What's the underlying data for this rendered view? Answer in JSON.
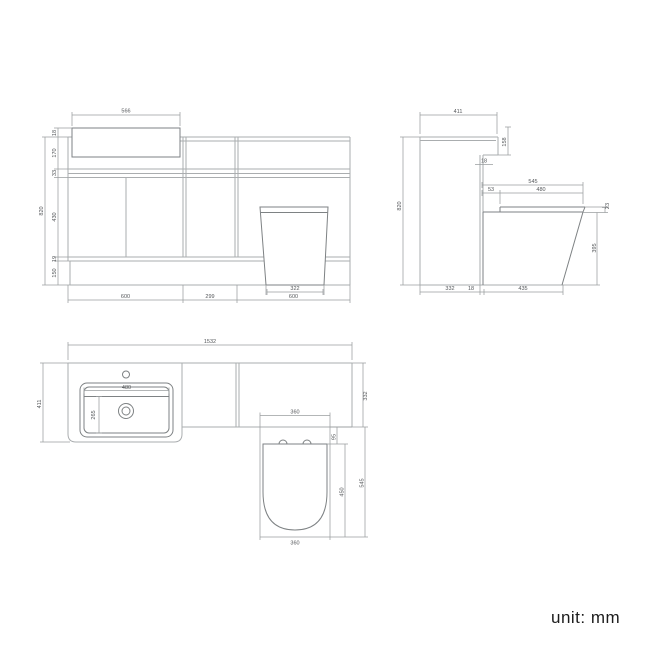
{
  "unit_note": "unit: mm",
  "front_view": {
    "dims": {
      "basin_width": "566",
      "basin_lip": "18",
      "counter_height": "170",
      "worktop_band": "33",
      "door_height": "430",
      "kick_gap": "19",
      "plinth_height": "150",
      "overall_height": "820",
      "left_unit_width": "600",
      "middle_unit_width": "299",
      "right_unit_width": "600",
      "toilet_base_width": "322"
    }
  },
  "side_view": {
    "dims": {
      "overall_depth": "411",
      "end_panel_drop": "158",
      "worktop_thickness": "18",
      "pan_projection_total": "545",
      "seat_setback": "53",
      "seat_length": "480",
      "seat_thickness": "23",
      "pan_height": "395",
      "overall_height": "820",
      "unit_depth": "332",
      "back_panel": "18",
      "pan_depth": "435"
    }
  },
  "plan_view": {
    "dims": {
      "overall_width": "1532",
      "vanity_depth": "411",
      "basin_width": "480",
      "basin_bowl_depth": "265",
      "wc_unit_depth": "332",
      "seat_offset": "95",
      "seat_length": "450",
      "pan_projection_total": "545",
      "seat_width": "360",
      "pan_width": "360"
    }
  }
}
